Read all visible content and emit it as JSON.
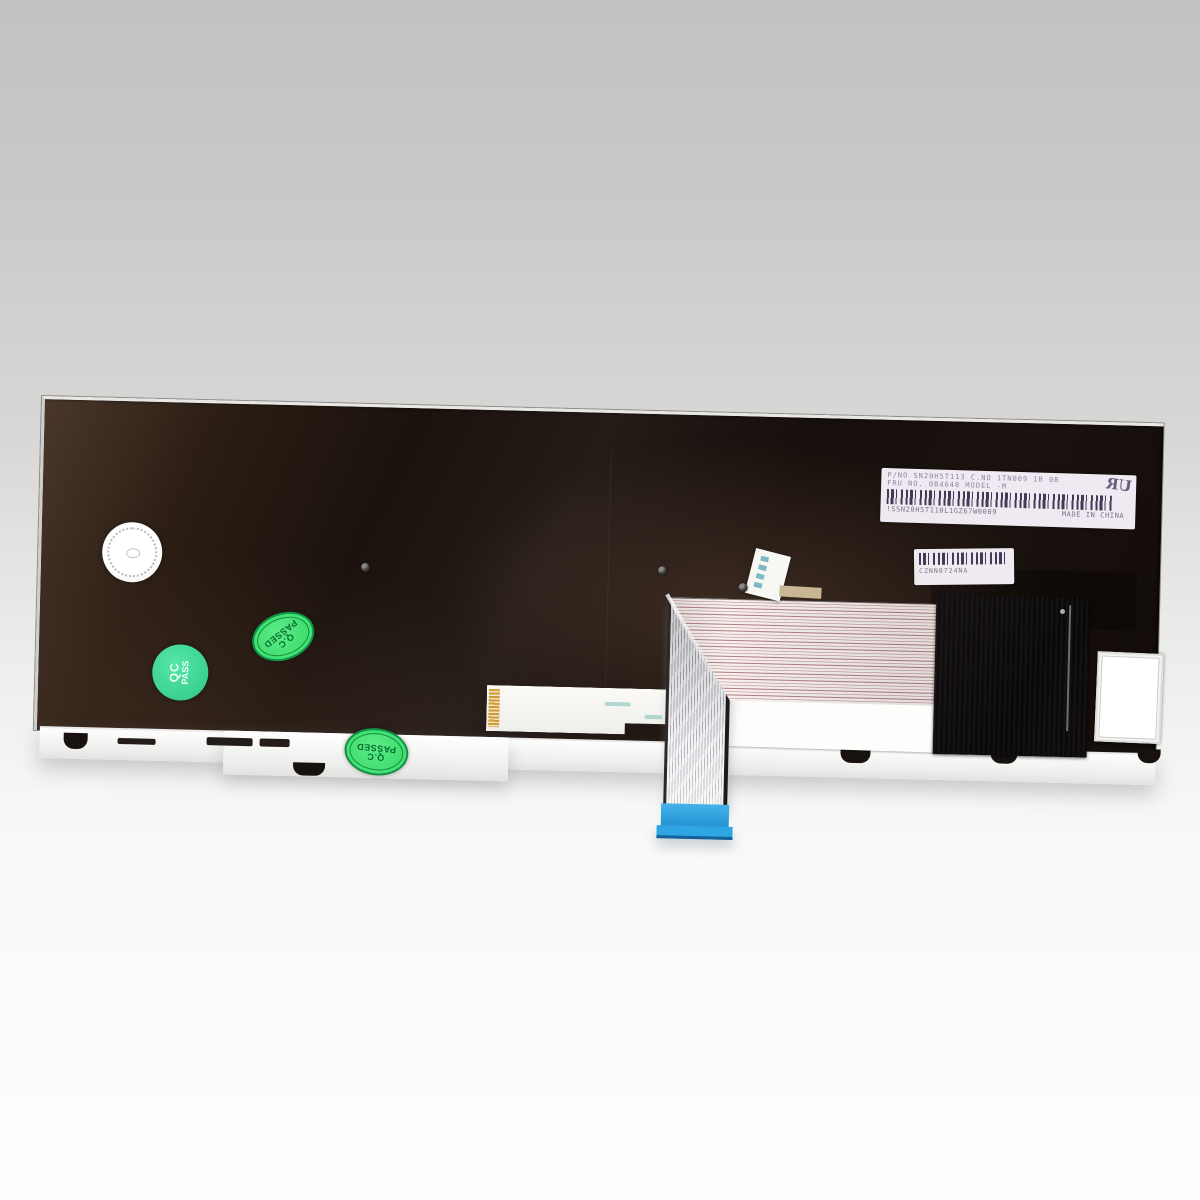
{
  "main_label": {
    "line1": "P/NO   SN20H5T113   C.NO 1TN009   1B 0B",
    "line2": "FRU NO. 0B4648      MODEL      -M",
    "serial": "!SSN20H5T110L1GZ67W0009",
    "origin": "MADE IN CHINA",
    "cert_mark": "UR"
  },
  "sub_label": {
    "code": "CZNN0724NA"
  },
  "stickers": {
    "qc_round": {
      "top": "QC",
      "bottom": "PASS"
    },
    "qc_oval": {
      "top": "Q.C",
      "bottom": "PASSED"
    }
  },
  "colors": {
    "qc_round_green": "#3fd795",
    "qc_oval_green": "#46df74",
    "qc_oval_ink": "#0a6c2e",
    "cable_blue": "#2aa3e4",
    "label_tint": "#efeaf2",
    "panel_black": "#150d0a",
    "background_top": "#c2c2c1",
    "background_bottom": "#fefefe"
  }
}
